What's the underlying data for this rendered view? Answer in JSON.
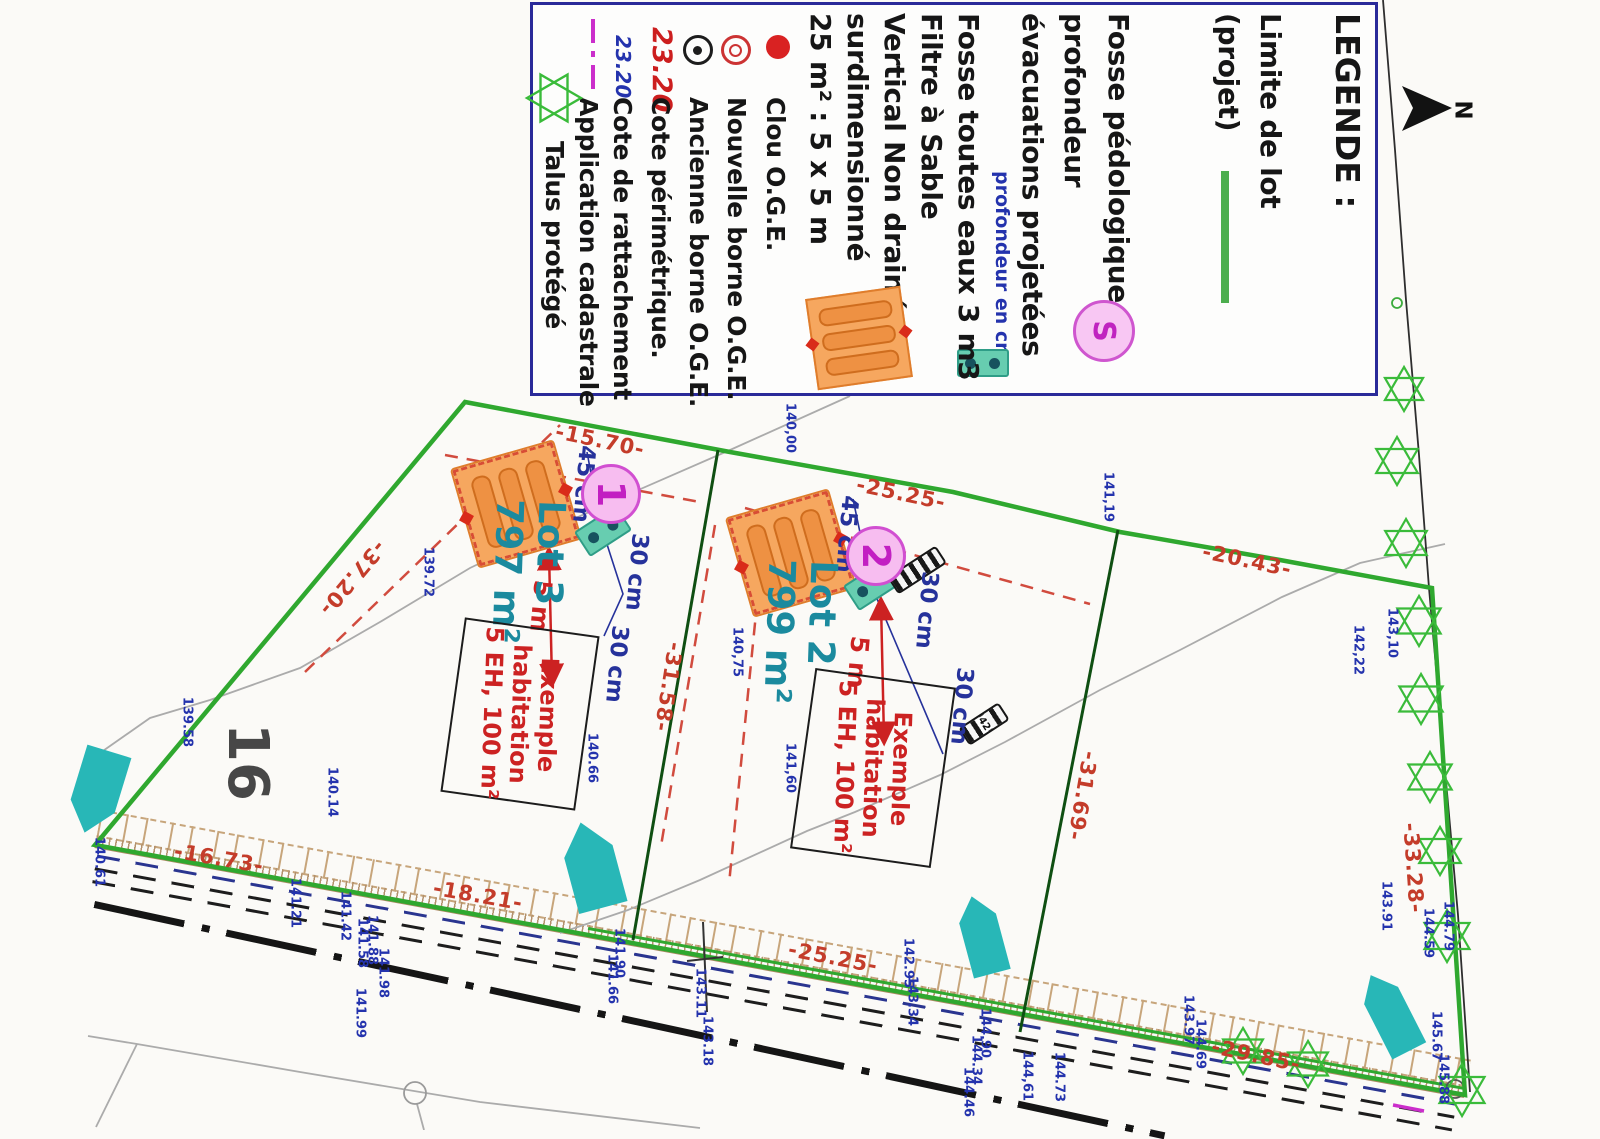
{
  "legend": {
    "title": "LEGENDE :",
    "items": [
      {
        "label": "Limite de lot",
        "label2": "(projet)",
        "icon": "green-line"
      },
      {
        "label": "Fosse pédologique :",
        "symbol": "S",
        "icon": "pink-s-circle"
      },
      {
        "label": "profondeur",
        "label2": "évacuations projetées",
        "note": "profondeur en cm",
        "icon": "teal-tank"
      },
      {
        "label": "Fosse toutes eaux 3 m3"
      },
      {
        "label": "Filtre à Sable"
      },
      {
        "label": "Vertical Non drainé"
      },
      {
        "label": "surdimensionné"
      },
      {
        "label": "25 m² : 5 x 5 m",
        "icon": "orange-sand-filter"
      },
      {
        "label": "Clou O.G.E.",
        "icon": "red-dot"
      },
      {
        "label": "Nouvelle borne O.G.E.",
        "icon": "red-ring"
      },
      {
        "label": "Ancienne borne O.G.E.",
        "icon": "black-target"
      },
      {
        "value": "23.20",
        "label": "Cote périmétrique.",
        "icon": "red-value"
      },
      {
        "value": "23.20",
        "label": "Cote de rattachement",
        "icon": "blue-value"
      },
      {
        "label": "Application cadastrale",
        "icon": "magenta-dashdot"
      },
      {
        "label": "Talus protégé",
        "icon": "green-star"
      }
    ]
  },
  "compass": {
    "label": "N"
  },
  "parcel_label": "16",
  "culvert_label": "42",
  "lots": [
    {
      "name": "Lot 3",
      "area": "797 m²",
      "marker": "1",
      "label_x": 528,
      "label_y": 572,
      "marker_x": 611,
      "marker_y": 494
    },
    {
      "name": "Lot 2",
      "area": "799 m²",
      "marker": "2",
      "label_x": 800,
      "label_y": 632,
      "marker_x": 876,
      "marker_y": 556
    }
  ],
  "habitations": [
    {
      "lines": [
        "Exemple",
        "habitation",
        "5 EH, 100 m²"
      ],
      "x": 520,
      "y": 714,
      "w": 132,
      "h": 172
    },
    {
      "lines": [
        "Exemple",
        "habitation",
        "5 EH, 100 m²"
      ],
      "x": 873,
      "y": 768,
      "w": 138,
      "h": 178
    }
  ],
  "measurements": [
    {
      "t": "-15.70-",
      "x": 600,
      "y": 441,
      "a": 12
    },
    {
      "t": "-25.25-",
      "x": 901,
      "y": 494,
      "a": 12
    },
    {
      "t": "-20.43-",
      "x": 1247,
      "y": 561,
      "a": 12
    },
    {
      "t": "-37.20-",
      "x": 352,
      "y": 578,
      "a": 130
    },
    {
      "t": "-31.58-",
      "x": 668,
      "y": 687,
      "a": 99
    },
    {
      "t": "-31.69-",
      "x": 1082,
      "y": 796,
      "a": 100
    },
    {
      "t": "-33.28-",
      "x": 1413,
      "y": 868,
      "a": 86
    },
    {
      "t": "-16.73-",
      "x": 219,
      "y": 859,
      "a": 10
    },
    {
      "t": "-18.21-",
      "x": 478,
      "y": 896,
      "a": 10
    },
    {
      "t": "-25.25-",
      "x": 833,
      "y": 958,
      "a": 11
    },
    {
      "t": "-29.85-",
      "x": 1256,
      "y": 1056,
      "a": 12
    }
  ],
  "dimensions": [
    {
      "t": "45 cm",
      "x": 583,
      "y": 484,
      "a": 95,
      "k": "dim"
    },
    {
      "t": "30 cm",
      "x": 636,
      "y": 572,
      "a": 95,
      "k": "dim"
    },
    {
      "t": "30 cm",
      "x": 616,
      "y": 664,
      "a": 95,
      "k": "dim"
    },
    {
      "t": "5 m",
      "x": 541,
      "y": 606,
      "a": 95,
      "k": "red5"
    },
    {
      "t": "45 cm",
      "x": 846,
      "y": 534,
      "a": 95,
      "k": "dim"
    },
    {
      "t": "30 cm",
      "x": 926,
      "y": 610,
      "a": 95,
      "k": "dim"
    },
    {
      "t": "30 cm",
      "x": 961,
      "y": 706,
      "a": 95,
      "k": "dim"
    },
    {
      "t": "5 m",
      "x": 858,
      "y": 662,
      "a": 95,
      "k": "red5"
    }
  ],
  "elevations": [
    {
      "t": "140,00",
      "x": 790,
      "y": 428
    },
    {
      "t": "139.72",
      "x": 428,
      "y": 572
    },
    {
      "t": "141,19",
      "x": 1108,
      "y": 497
    },
    {
      "t": "142,22",
      "x": 1358,
      "y": 650
    },
    {
      "t": "143,10",
      "x": 1392,
      "y": 633
    },
    {
      "t": "140,75",
      "x": 737,
      "y": 652
    },
    {
      "t": "141,60",
      "x": 790,
      "y": 768
    },
    {
      "t": "140.66",
      "x": 592,
      "y": 758
    },
    {
      "t": "139.58",
      "x": 187,
      "y": 722
    },
    {
      "t": "140.14",
      "x": 332,
      "y": 792
    },
    {
      "t": "140.61",
      "x": 99,
      "y": 862
    },
    {
      "t": "141.21",
      "x": 295,
      "y": 903
    },
    {
      "t": "141.42",
      "x": 345,
      "y": 916
    },
    {
      "t": "141.58",
      "x": 362,
      "y": 943
    },
    {
      "t": "141.88",
      "x": 372,
      "y": 940
    },
    {
      "t": "141.98",
      "x": 383,
      "y": 973
    },
    {
      "t": "141.99",
      "x": 360,
      "y": 1013
    },
    {
      "t": "141.90",
      "x": 619,
      "y": 953
    },
    {
      "t": "141.66",
      "x": 612,
      "y": 979
    },
    {
      "t": "143.11",
      "x": 700,
      "y": 993
    },
    {
      "t": "143.18",
      "x": 707,
      "y": 1041
    },
    {
      "t": "142.95",
      "x": 908,
      "y": 963
    },
    {
      "t": "143.34",
      "x": 912,
      "y": 1001
    },
    {
      "t": "144.90",
      "x": 985,
      "y": 1033
    },
    {
      "t": "144.34",
      "x": 976,
      "y": 1060
    },
    {
      "t": "144.46",
      "x": 968,
      "y": 1092
    },
    {
      "t": "144,61",
      "x": 1027,
      "y": 1076
    },
    {
      "t": "144.73",
      "x": 1059,
      "y": 1077
    },
    {
      "t": "143.97",
      "x": 1188,
      "y": 1020
    },
    {
      "t": "144.69",
      "x": 1200,
      "y": 1044
    },
    {
      "t": "143.91",
      "x": 1386,
      "y": 906
    },
    {
      "t": "144.59",
      "x": 1428,
      "y": 933
    },
    {
      "t": "144.79",
      "x": 1448,
      "y": 926
    },
    {
      "t": "145.67",
      "x": 1436,
      "y": 1036
    },
    {
      "t": "145.88",
      "x": 1443,
      "y": 1079
    }
  ],
  "stars": [
    {
      "x": 1404,
      "y": 389,
      "r": 22
    },
    {
      "x": 1397,
      "y": 461,
      "r": 24
    },
    {
      "x": 1406,
      "y": 543,
      "r": 24
    },
    {
      "x": 1419,
      "y": 621,
      "r": 25
    },
    {
      "x": 1421,
      "y": 699,
      "r": 25
    },
    {
      "x": 1430,
      "y": 777,
      "r": 25
    },
    {
      "x": 1440,
      "y": 851,
      "r": 24
    },
    {
      "x": 1447,
      "y": 936,
      "r": 26
    },
    {
      "x": 1462,
      "y": 1090,
      "r": 26
    },
    {
      "x": 1308,
      "y": 1064,
      "r": 23
    },
    {
      "x": 1243,
      "y": 1051,
      "r": 23
    }
  ],
  "flow_arrows": [
    {
      "x": 592,
      "y": 865,
      "w": 50,
      "h": 88,
      "a": -15
    },
    {
      "x": 982,
      "y": 935,
      "w": 38,
      "h": 80,
      "a": -15
    },
    {
      "x": 1390,
      "y": 1013,
      "w": 38,
      "h": 85,
      "a": -27
    },
    {
      "x": 97,
      "y": 792,
      "w": 46,
      "h": 85,
      "a": 197
    }
  ],
  "colors": {
    "boundary_green": "#2fa82f",
    "divider_green": "#0f4f12",
    "measure_red": "#c43c2a",
    "elevation_blue": "#2433ad",
    "lot_teal": "#1b8a9e",
    "marker_magenta": "#c21fc2",
    "star_green": "#3abb3a",
    "flow_teal": "#28b7b7",
    "hatch_tan": "#b3916c",
    "legend_border": "#2a2a99"
  }
}
